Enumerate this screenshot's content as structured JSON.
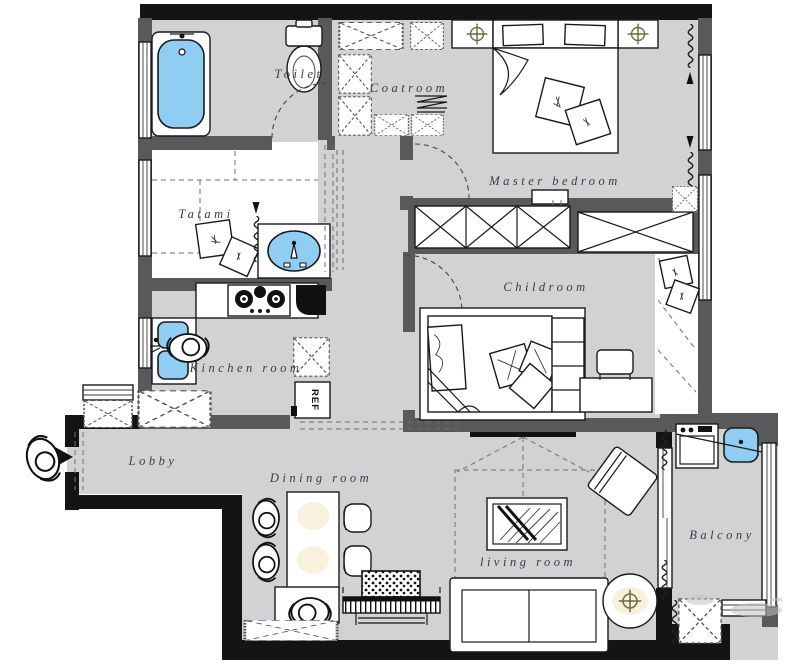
{
  "plan": {
    "type": "apartment-floor-plan",
    "rooms": {
      "toilet": {
        "label": "Toilet"
      },
      "coatroom": {
        "label": "Coatroom"
      },
      "master_bedroom": {
        "label": "Master bedroom"
      },
      "tatami": {
        "label": "Tatami"
      },
      "childroom": {
        "label": "Childroom"
      },
      "kitchen": {
        "label": "Kinchen room"
      },
      "lobby": {
        "label": "Lobby"
      },
      "dining_room": {
        "label": "Dining room"
      },
      "living_room": {
        "label": "living room"
      },
      "balcony": {
        "label": "Balcony"
      }
    },
    "appliances": {
      "refrigerator_label": "REF"
    },
    "colors": {
      "floor_gray": "#d2d2d4",
      "wall_dark_gray": "#59595c",
      "wall_black": "#141414",
      "fixture_blue": "#8fcdf2",
      "lamp_olive": "#6f6f45"
    }
  }
}
